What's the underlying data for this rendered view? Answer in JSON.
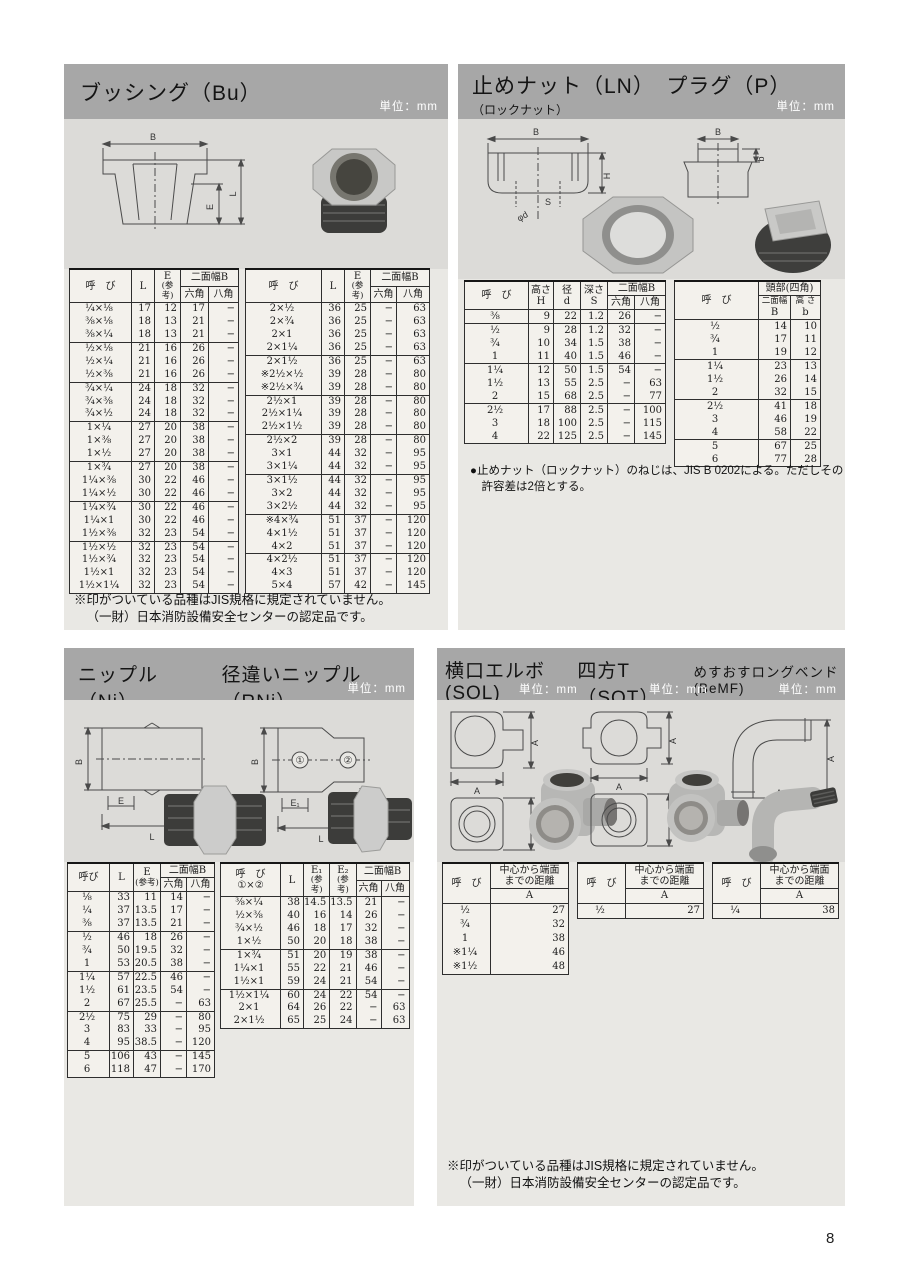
{
  "page_number": "8",
  "common": {
    "unit": "単位：mm",
    "yobi": "呼　び",
    "yobi_compact": "呼び",
    "L": "L",
    "E": "E",
    "E1": "E₁",
    "E2": "E₂",
    "sankou": "(参考)",
    "nimen_b": "二面幅B",
    "hex": "六角",
    "oct": "八角",
    "A": "A",
    "dist1": "中心から端面",
    "dist2": "までの距離",
    "jis_note1": "※印がついている品種はJIS規格に規定されていません。",
    "jis_note2": "（一財）日本消防設備安全センターの認定品です。"
  },
  "diagram_labels": {
    "B": "B",
    "E": "E",
    "L": "L",
    "H": "H",
    "phid": "φd",
    "S": "S",
    "b": "b",
    "E1": "E₁",
    "E2": "E₂",
    "A": "A",
    "c1": "①",
    "c2": "②"
  },
  "bushing": {
    "title": "ブッシング（Bu）",
    "left_groups": [
      [
        [
          "¼×⅛",
          "17",
          "12",
          "17",
          "−"
        ],
        [
          "⅜×⅛",
          "18",
          "13",
          "21",
          "−"
        ],
        [
          "⅜×¼",
          "18",
          "13",
          "21",
          "−"
        ]
      ],
      [
        [
          "½×⅛",
          "21",
          "16",
          "26",
          "−"
        ],
        [
          "½×¼",
          "21",
          "16",
          "26",
          "−"
        ],
        [
          "½×⅜",
          "21",
          "16",
          "26",
          "−"
        ]
      ],
      [
        [
          "¾×¼",
          "24",
          "18",
          "32",
          "−"
        ],
        [
          "¾×⅜",
          "24",
          "18",
          "32",
          "−"
        ],
        [
          "¾×½",
          "24",
          "18",
          "32",
          "−"
        ]
      ],
      [
        [
          "1×¼",
          "27",
          "20",
          "38",
          "−"
        ],
        [
          "1×⅜",
          "27",
          "20",
          "38",
          "−"
        ],
        [
          "1×½",
          "27",
          "20",
          "38",
          "−"
        ]
      ],
      [
        [
          "1×¾",
          "27",
          "20",
          "38",
          "−"
        ],
        [
          "1¼×⅜",
          "30",
          "22",
          "46",
          "−"
        ],
        [
          "1¼×½",
          "30",
          "22",
          "46",
          "−"
        ]
      ],
      [
        [
          "1¼×¾",
          "30",
          "22",
          "46",
          "−"
        ],
        [
          "1¼×1",
          "30",
          "22",
          "46",
          "−"
        ],
        [
          "1½×⅜",
          "32",
          "23",
          "54",
          "−"
        ]
      ],
      [
        [
          "1½×½",
          "32",
          "23",
          "54",
          "−"
        ],
        [
          "1½×¾",
          "32",
          "23",
          "54",
          "−"
        ],
        [
          "1½×1",
          "32",
          "23",
          "54",
          "−"
        ],
        [
          "1½×1¼",
          "32",
          "23",
          "54",
          "−"
        ]
      ]
    ],
    "right_groups": [
      [
        [
          "2×½",
          "36",
          "25",
          "−",
          "63"
        ],
        [
          "2×¾",
          "36",
          "25",
          "−",
          "63"
        ],
        [
          "2×1",
          "36",
          "25",
          "−",
          "63"
        ],
        [
          "2×1¼",
          "36",
          "25",
          "−",
          "63"
        ]
      ],
      [
        [
          "2×1½",
          "36",
          "25",
          "−",
          "63"
        ],
        [
          "※2½×½",
          "39",
          "28",
          "−",
          "80"
        ],
        [
          "※2½×¾",
          "39",
          "28",
          "−",
          "80"
        ]
      ],
      [
        [
          "2½×1",
          "39",
          "28",
          "−",
          "80"
        ],
        [
          "2½×1¼",
          "39",
          "28",
          "−",
          "80"
        ],
        [
          "2½×1½",
          "39",
          "28",
          "−",
          "80"
        ]
      ],
      [
        [
          "2½×2",
          "39",
          "28",
          "−",
          "80"
        ],
        [
          "3×1",
          "44",
          "32",
          "−",
          "95"
        ],
        [
          "3×1¼",
          "44",
          "32",
          "−",
          "95"
        ]
      ],
      [
        [
          "3×1½",
          "44",
          "32",
          "−",
          "95"
        ],
        [
          "3×2",
          "44",
          "32",
          "−",
          "95"
        ],
        [
          "3×2½",
          "44",
          "32",
          "−",
          "95"
        ]
      ],
      [
        [
          "※4×¾",
          "51",
          "37",
          "−",
          "120"
        ],
        [
          "4×1½",
          "51",
          "37",
          "−",
          "120"
        ],
        [
          "4×2",
          "51",
          "37",
          "−",
          "120"
        ]
      ],
      [
        [
          "4×2½",
          "51",
          "37",
          "−",
          "120"
        ],
        [
          "4×3",
          "51",
          "37",
          "−",
          "120"
        ],
        [
          "5×4",
          "57",
          "42",
          "−",
          "145"
        ]
      ]
    ]
  },
  "locknut_plug": {
    "title": "止めナット（LN）　プラグ（P）",
    "subtitle": "（ロックナット）",
    "ln_head": {
      "takasa": "高さ",
      "H": "H",
      "kei": "径",
      "d": "d",
      "fukasa": "深さ",
      "S": "S"
    },
    "p_head": {
      "toubu": "頭部(四角)",
      "nimen": "二面幅",
      "B": "B",
      "takasa": "高 さ",
      "b": "b"
    },
    "ln_groups": [
      [
        [
          "⅜",
          "9",
          "22",
          "1.2",
          "26",
          "−"
        ]
      ],
      [
        [
          "½",
          "9",
          "28",
          "1.2",
          "32",
          "−"
        ],
        [
          "¾",
          "10",
          "34",
          "1.5",
          "38",
          "−"
        ],
        [
          "1",
          "11",
          "40",
          "1.5",
          "46",
          "−"
        ]
      ],
      [
        [
          "1¼",
          "12",
          "50",
          "1.5",
          "54",
          "−"
        ],
        [
          "1½",
          "13",
          "55",
          "2.5",
          "−",
          "63"
        ],
        [
          "2",
          "15",
          "68",
          "2.5",
          "−",
          "77"
        ]
      ],
      [
        [
          "2½",
          "17",
          "88",
          "2.5",
          "−",
          "100"
        ],
        [
          "3",
          "18",
          "100",
          "2.5",
          "−",
          "115"
        ],
        [
          "4",
          "22",
          "125",
          "2.5",
          "−",
          "145"
        ]
      ]
    ],
    "p_groups": [
      [
        [
          "½",
          "14",
          "10"
        ],
        [
          "¾",
          "17",
          "11"
        ],
        [
          "1",
          "19",
          "12"
        ]
      ],
      [
        [
          "1¼",
          "23",
          "13"
        ],
        [
          "1½",
          "26",
          "14"
        ],
        [
          "2",
          "32",
          "15"
        ]
      ],
      [
        [
          "2½",
          "41",
          "18"
        ],
        [
          "3",
          "46",
          "19"
        ],
        [
          "4",
          "58",
          "22"
        ]
      ],
      [
        [
          "5",
          "67",
          "25"
        ],
        [
          "6",
          "77",
          "28"
        ]
      ]
    ],
    "note": "●止めナット（ロックナット）のねじは、JIS B 0202による。ただしその許容差は2倍とする。"
  },
  "nipple": {
    "title_ni": "ニップル（Ni）",
    "title_rni": "径違いニップル（RNi）",
    "rni_sub": "①×②",
    "ni_groups": [
      [
        [
          "⅛",
          "33",
          "11",
          "14",
          "−"
        ],
        [
          "¼",
          "37",
          "13.5",
          "17",
          "−"
        ],
        [
          "⅜",
          "37",
          "13.5",
          "21",
          "−"
        ]
      ],
      [
        [
          "½",
          "46",
          "18",
          "26",
          "−"
        ],
        [
          "¾",
          "50",
          "19.5",
          "32",
          "−"
        ],
        [
          "1",
          "53",
          "20.5",
          "38",
          "−"
        ]
      ],
      [
        [
          "1¼",
          "57",
          "22.5",
          "46",
          "−"
        ],
        [
          "1½",
          "61",
          "23.5",
          "54",
          "−"
        ],
        [
          "2",
          "67",
          "25.5",
          "−",
          "63"
        ]
      ],
      [
        [
          "2½",
          "75",
          "29",
          "−",
          "80"
        ],
        [
          "3",
          "83",
          "33",
          "−",
          "95"
        ],
        [
          "4",
          "95",
          "38.5",
          "−",
          "120"
        ]
      ],
      [
        [
          "5",
          "106",
          "43",
          "−",
          "145"
        ],
        [
          "6",
          "118",
          "47",
          "−",
          "170"
        ]
      ]
    ],
    "rni_groups": [
      [
        [
          "⅜×¼",
          "38",
          "14.5",
          "13.5",
          "21",
          "−"
        ],
        [
          "½×⅜",
          "40",
          "16",
          "14",
          "26",
          "−"
        ],
        [
          "¾×½",
          "46",
          "18",
          "17",
          "32",
          "−"
        ],
        [
          "1×½",
          "50",
          "20",
          "18",
          "38",
          "−"
        ]
      ],
      [
        [
          "1×¾",
          "51",
          "20",
          "19",
          "38",
          "−"
        ],
        [
          "1¼×1",
          "55",
          "22",
          "21",
          "46",
          "−"
        ],
        [
          "1½×1",
          "59",
          "24",
          "21",
          "54",
          "−"
        ]
      ],
      [
        [
          "1½×1¼",
          "60",
          "24",
          "22",
          "54",
          "−"
        ],
        [
          "2×1",
          "64",
          "26",
          "22",
          "−",
          "63"
        ],
        [
          "2×1½",
          "65",
          "25",
          "24",
          "−",
          "63"
        ]
      ]
    ]
  },
  "sol_sot_bemf": {
    "title_sol": "横口エルボ(SOL)",
    "title_sot": "四方T（SOT）",
    "title_bemf": "めすおすロングベンド(BeMF)",
    "sol_groups": [
      [
        [
          "½",
          "27"
        ],
        [
          "¾",
          "32"
        ],
        [
          "1",
          "38"
        ],
        [
          "※1¼",
          "46"
        ],
        [
          "※1½",
          "48"
        ]
      ]
    ],
    "sot_groups": [
      [
        [
          "½",
          "27"
        ]
      ]
    ],
    "bemf_groups": [
      [
        [
          "¼",
          "38"
        ]
      ]
    ]
  }
}
